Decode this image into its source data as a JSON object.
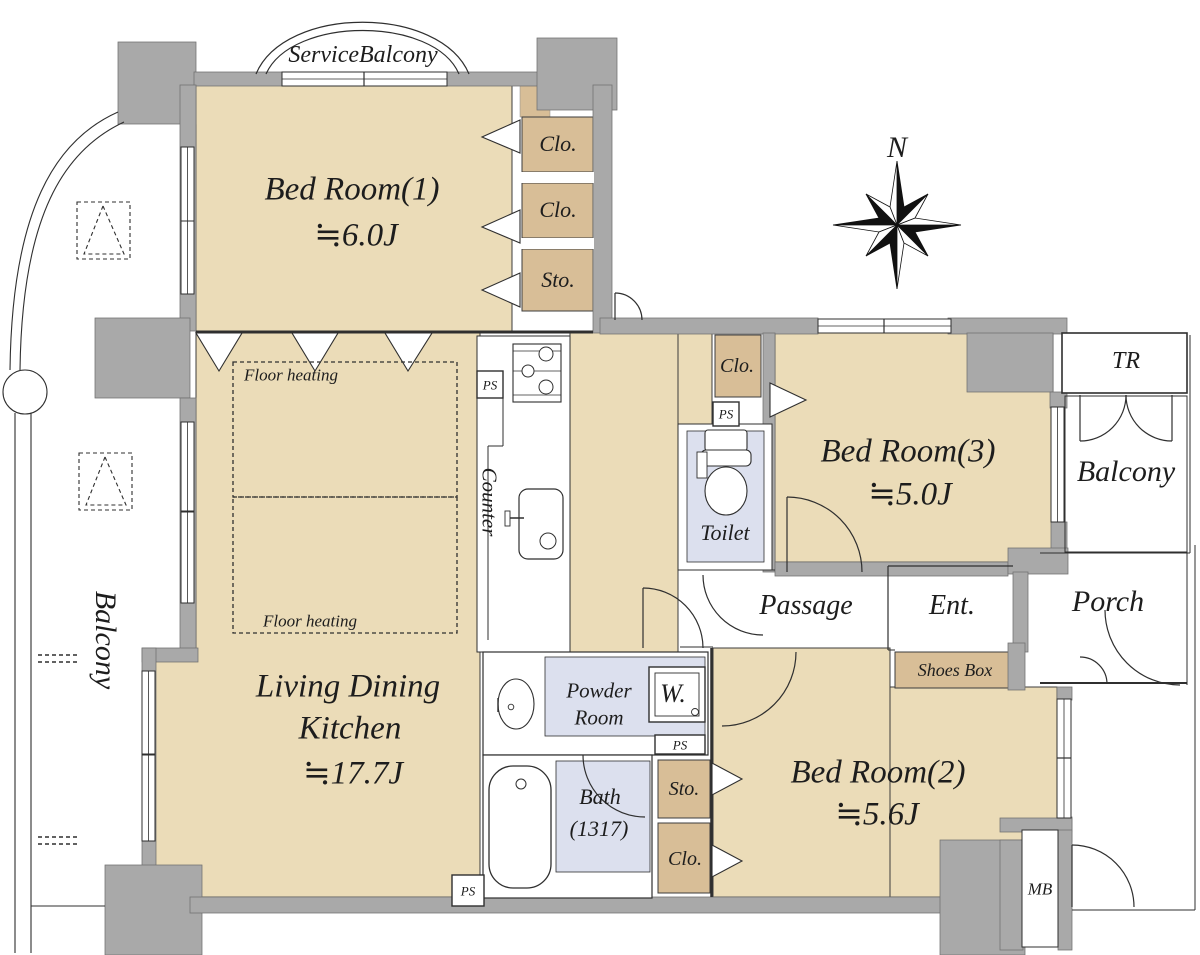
{
  "colors": {
    "room_fill": "#EBDCB8",
    "closet_fill": "#D8BE97",
    "wet_area_fill": "#DCE0EE",
    "wall": "#A9A9A9",
    "line": "#2f2f2f"
  },
  "compass_label": "N",
  "rooms": {
    "service_balcony": "ServiceBalcony",
    "bedroom1_name": "Bed Room(1)",
    "bedroom1_size": "≒6.0J",
    "bedroom2_name": "Bed Room(2)",
    "bedroom2_size": "≒5.6J",
    "bedroom3_name": "Bed Room(3)",
    "bedroom3_size": "≒5.0J",
    "ldk_line1": "Living Dining",
    "ldk_line2": "Kitchen",
    "ldk_size": "≒17.7J",
    "toilet": "Toilet",
    "powder_line1": "Powder",
    "powder_line2": "Room",
    "bath_name": "Bath",
    "bath_size": "(1317)",
    "passage": "Passage",
    "entrance": "Ent.",
    "porch": "Porch",
    "balcony_left": "Balcony",
    "balcony_right": "Balcony",
    "trunk_room": "TR",
    "meter_box": "MB"
  },
  "storage": {
    "closet1": "Clo.",
    "closet2": "Clo.",
    "storage1": "Sto.",
    "closet_hall": "Clo.",
    "storage2": "Sto.",
    "closet_br2": "Clo.",
    "shoes_box": "Shoes Box"
  },
  "labels": {
    "floor_heating": "Floor heating",
    "ps": "PS",
    "counter": "Counter",
    "washer": "W."
  }
}
